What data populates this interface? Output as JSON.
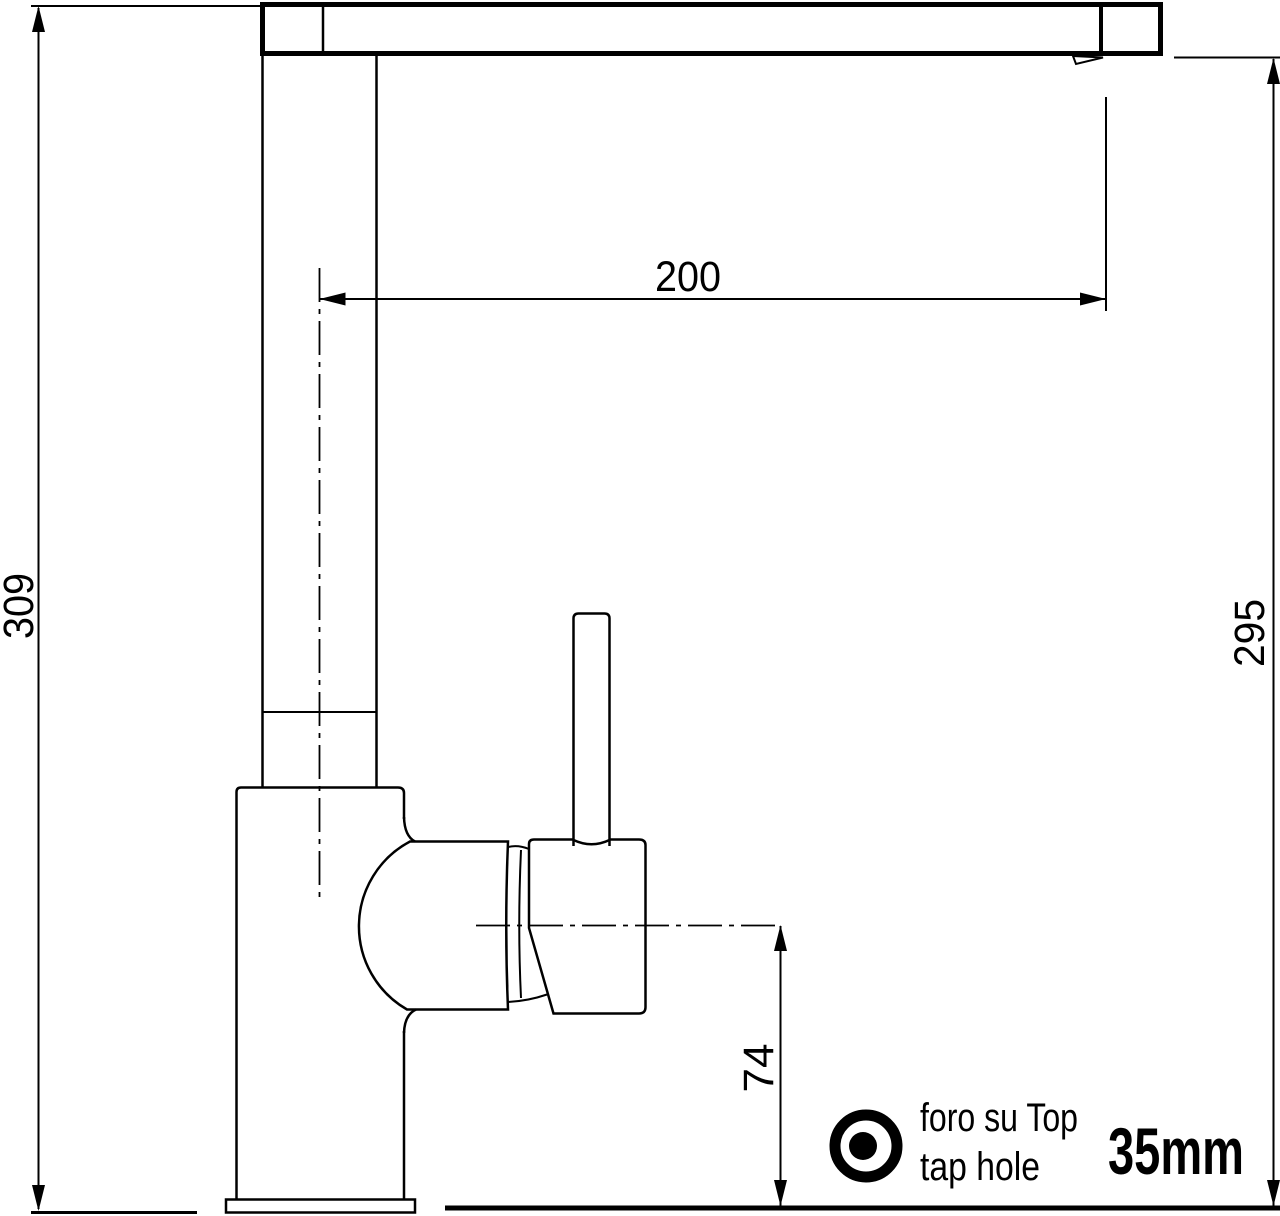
{
  "drawing": {
    "subject": "single-lever kitchen tap side elevation, dimensioned",
    "dimensions": {
      "overall_height": "309",
      "spout_reach": "200",
      "spout_height": "295",
      "body_center_height": "74"
    },
    "annotation": {
      "line_it": "foro su Top",
      "line_en": "tap hole",
      "hole_size": "35mm"
    },
    "colors": {
      "line": "#000000",
      "background": "#ffffff"
    }
  }
}
